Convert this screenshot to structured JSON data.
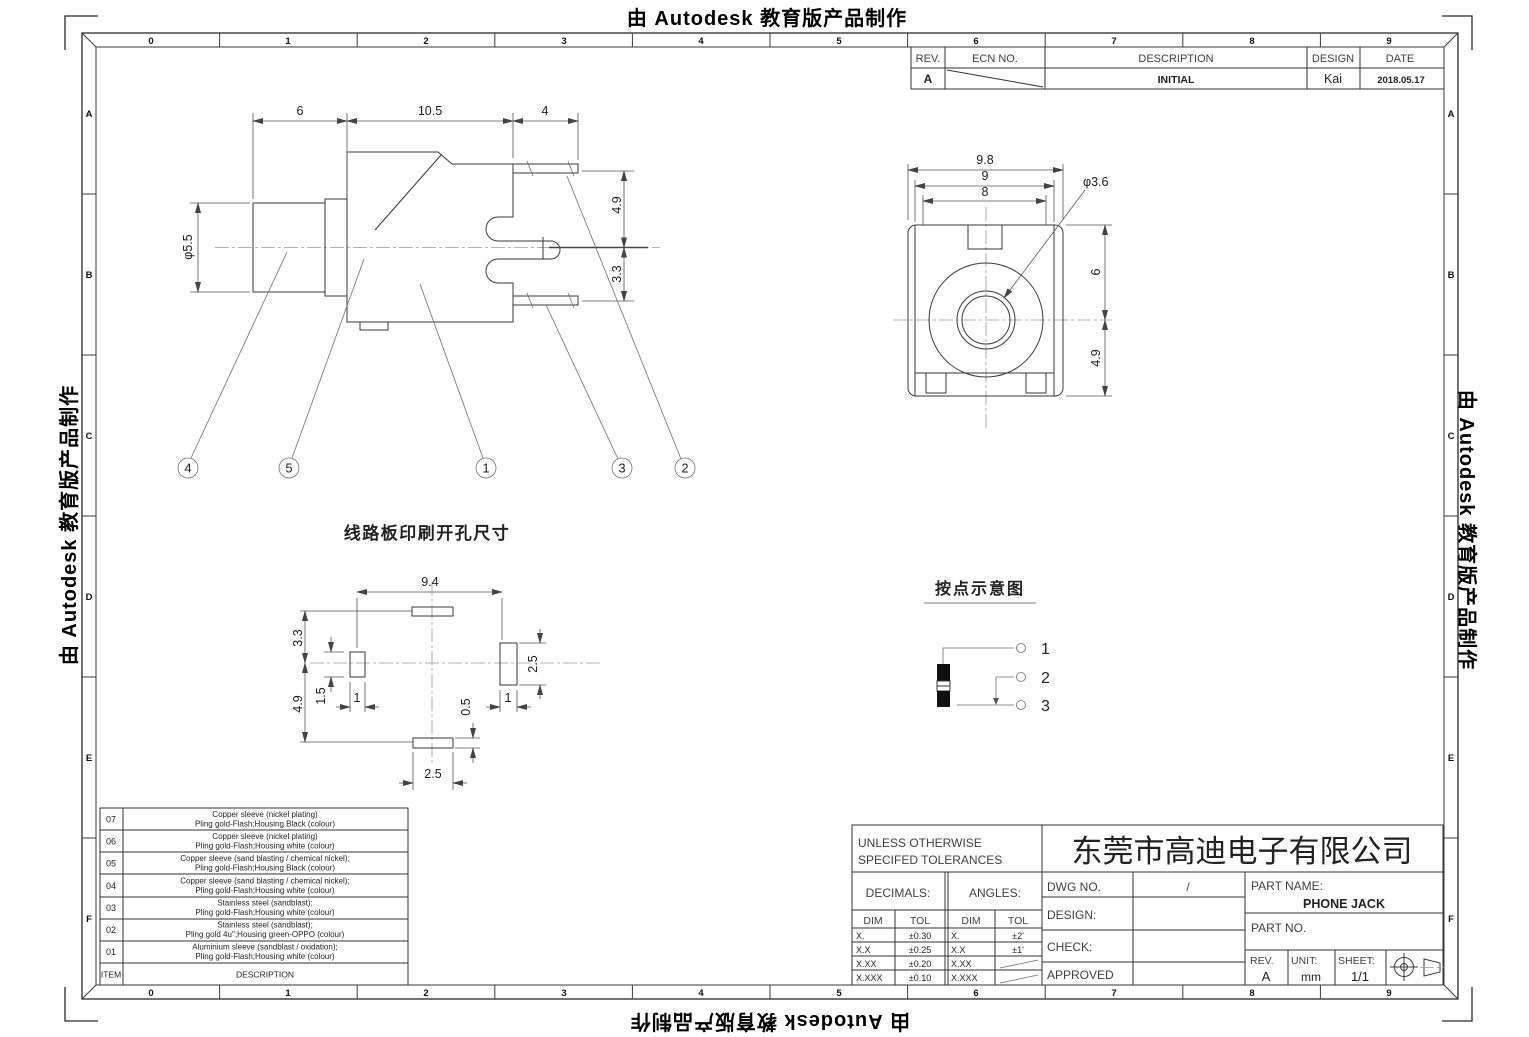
{
  "watermark": {
    "text": "由 Autodesk 教育版产品制作"
  },
  "frame": {
    "cols": [
      "0",
      "1",
      "2",
      "3",
      "4",
      "5",
      "6",
      "7",
      "8",
      "9"
    ],
    "rows": [
      "A",
      "B",
      "C",
      "D",
      "E",
      "F"
    ]
  },
  "revision_table": {
    "headers": {
      "rev": "REV.",
      "ecn": "ECN NO.",
      "description": "DESCRIPTION",
      "design": "DESIGN",
      "date": "DATE"
    },
    "row": {
      "rev": "A",
      "description": "INITIAL",
      "design": "Kai",
      "date": "2018.05.17"
    }
  },
  "side_view": {
    "dim_6": "6",
    "dim_10_5": "10.5",
    "dim_4": "4",
    "dim_dia": "φ5.5",
    "dim_4_9": "4.9",
    "dim_3_3": "3.3",
    "balloons": [
      "4",
      "5",
      "1",
      "3",
      "2"
    ]
  },
  "front_view": {
    "dim_9_8": "9.8",
    "dim_9": "9",
    "dim_8": "8",
    "dim_hole": "φ3.6",
    "dim_6": "6",
    "dim_4_9": "4.9"
  },
  "pcb_view": {
    "title": "线路板印刷开孔尺寸",
    "dim_9_4": "9.4",
    "dim_3_3": "3.3",
    "dim_4_9": "4.9",
    "dim_1_5": "1.5",
    "dim_1_left": "1",
    "dim_2_5_right": "2.5",
    "dim_1_right": "1",
    "dim_0_5": "0.5",
    "dim_2_5_bottom": "2.5"
  },
  "pin_diagram": {
    "title": "按点示意图",
    "pins": [
      "1",
      "2",
      "3"
    ]
  },
  "materials": {
    "item_header": "ITEM",
    "desc_header": "DESCRIPTION",
    "rows": [
      {
        "item": "07",
        "l1": "Copper sleeve (nickel plating)",
        "l2": "Pling gold-Flash;Housing Black (colour)"
      },
      {
        "item": "06",
        "l1": "Copper sleeve (nickel plating)",
        "l2": "Pling gold-Flash;Housing white (colour)"
      },
      {
        "item": "05",
        "l1": "Copper sleeve (sand blasting / chemical nickel);",
        "l2": "Pling gold-Flash;Housing Black (colour)"
      },
      {
        "item": "04",
        "l1": "Copper sleeve (sand blasting / chemical nickel);",
        "l2": "Pling gold-Flash;Housing white (colour)"
      },
      {
        "item": "03",
        "l1": "Stainless steel (sandblast);",
        "l2": "Pling gold-Flash;Housing white (colour)"
      },
      {
        "item": "02",
        "l1": "Stainless steel (sandblast);",
        "l2": "Pling gold 4u'';Housing green-OPPO (colour)"
      },
      {
        "item": "01",
        "l1": "Aluminium sleeve (sandblast / oxidation);",
        "l2": "Pling gold-Flash;Housing white (colour)"
      }
    ]
  },
  "title_block": {
    "note_line1": "UNLESS OTHERWISE",
    "note_line2": "SPECIFED TOLERANCES",
    "decimals_label": "DECIMALS:",
    "angles_label": "ANGLES:",
    "dim_header": "DIM",
    "tol_header": "TOL",
    "decimals": [
      {
        "dim": "X.",
        "tol": "±0.30"
      },
      {
        "dim": "X.X",
        "tol": "±0.25"
      },
      {
        "dim": "X.XX",
        "tol": "±0.20"
      },
      {
        "dim": "X.XXX",
        "tol": "±0.10"
      }
    ],
    "angles": [
      {
        "dim": "X.",
        "tol": "±2'"
      },
      {
        "dim": "X.X",
        "tol": "±1'"
      },
      {
        "dim": "X.XX",
        "tol": ""
      },
      {
        "dim": "X.XXX",
        "tol": ""
      }
    ],
    "dwg_no_label": "DWG NO.",
    "dwg_no_value": "/",
    "design_label": "DESIGN:",
    "check_label": "CHECK:",
    "approved_label": "APPROVED",
    "company": "东莞市高迪电子有限公司",
    "part_name_label": "PART NAME:",
    "part_name_value": "PHONE JACK",
    "part_no_label": "PART NO.",
    "rev_label": "REV.",
    "rev_value": "A",
    "unit_label": "UNIT:",
    "unit_value": "mm",
    "sheet_label": "SHEET:",
    "sheet_value": "1/1"
  }
}
